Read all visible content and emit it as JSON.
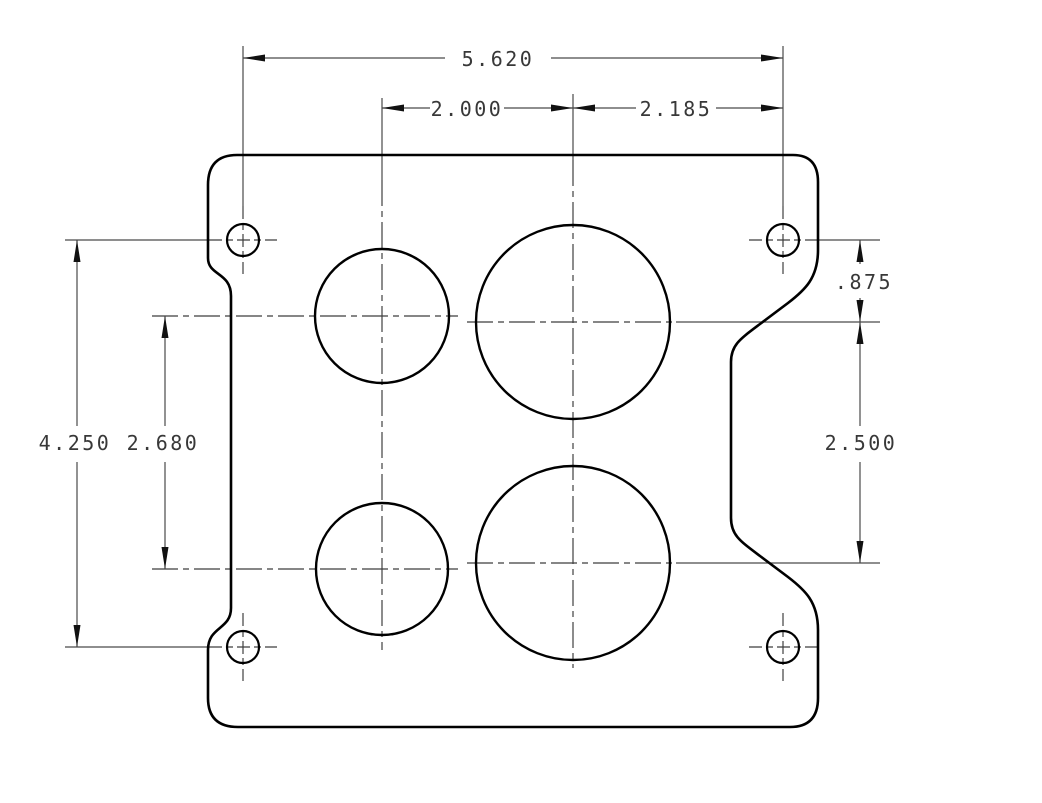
{
  "drawing": {
    "subject": "four-bore carburetor flange gasket plate",
    "style": "2D CAD dimensioned drawing",
    "units": "inches",
    "background_color": "#ffffff",
    "outline_color": "#000000",
    "dimension_line_color": "#4a4a4a",
    "text_color": "#383838",
    "features": {
      "mounting_holes_count": 4,
      "bores_count": 4,
      "small_bores": "left column (2)",
      "large_bores": "right column (2)"
    },
    "dimensions": [
      {
        "id": "stud-span-horizontal",
        "value": "5.620",
        "orientation": "horizontal",
        "measures": "mounting stud spacing, left to right"
      },
      {
        "id": "bore-columns-left",
        "value": "2.000",
        "orientation": "horizontal",
        "measures": "small bore column to large bore column"
      },
      {
        "id": "bore-column-to-stud",
        "value": "2.185",
        "orientation": "horizontal",
        "measures": "large bore column to right stud line"
      },
      {
        "id": "stud-to-primary-row",
        "value": ".875",
        "orientation": "vertical",
        "measures": "stud centerline to upper large bore centerline"
      },
      {
        "id": "primary-to-secondary-row",
        "value": "2.500",
        "orientation": "vertical",
        "measures": "upper large bore to lower large bore centerline"
      },
      {
        "id": "stud-span-vertical",
        "value": "4.250",
        "orientation": "vertical",
        "measures": "mounting stud spacing, top to bottom"
      },
      {
        "id": "small-bore-rows",
        "value": "2.680",
        "orientation": "vertical",
        "measures": "upper small bore to lower small bore centerline"
      }
    ]
  }
}
